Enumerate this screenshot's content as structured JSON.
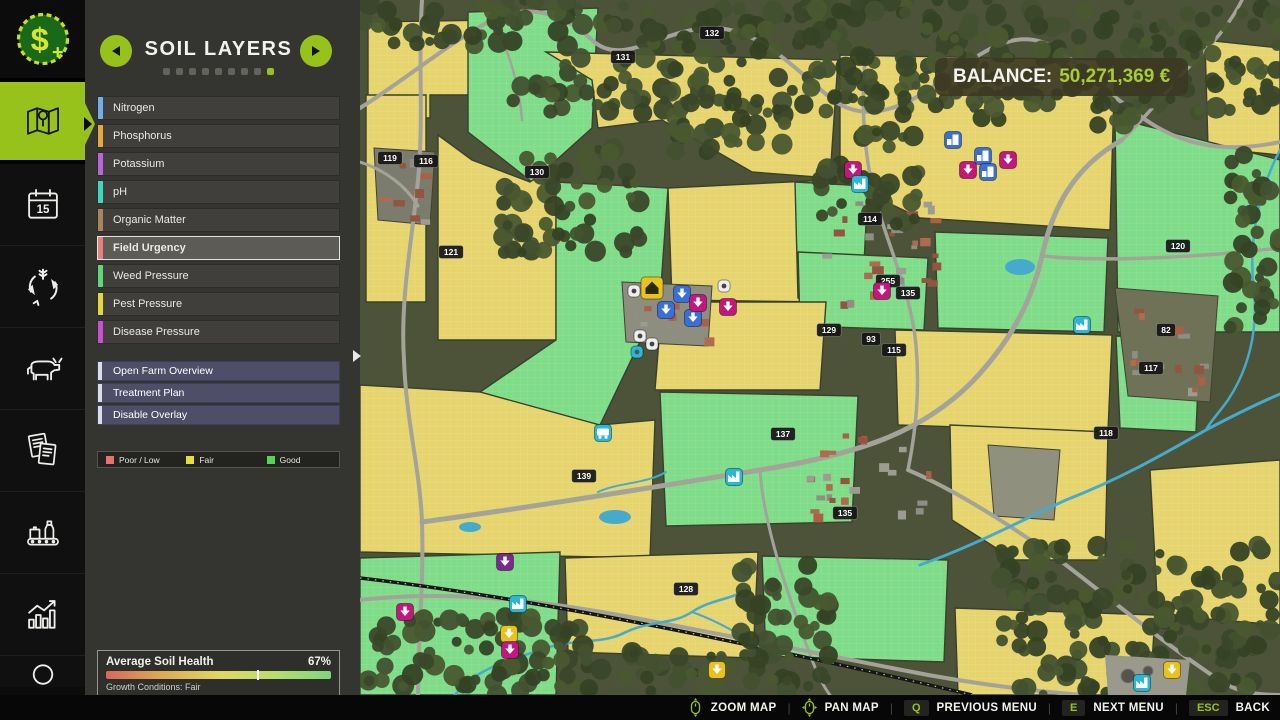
{
  "sidebar": {
    "items": [
      {
        "name": "finances",
        "icon": "money-icon"
      },
      {
        "name": "map",
        "icon": "map-icon",
        "active": true
      },
      {
        "name": "calendar",
        "icon": "calendar-icon",
        "day": "15"
      },
      {
        "name": "crop-rotation",
        "icon": "rotation-icon"
      },
      {
        "name": "animals",
        "icon": "cow-icon"
      },
      {
        "name": "contracts",
        "icon": "contracts-icon"
      },
      {
        "name": "production",
        "icon": "production-icon"
      },
      {
        "name": "statistics",
        "icon": "stats-icon"
      },
      {
        "name": "player",
        "icon": "person-icon"
      }
    ]
  },
  "panel": {
    "title": "SOIL LAYERS",
    "dots_total": 9,
    "dots_active_index": 8,
    "layers": [
      {
        "label": "Nitrogen",
        "color": "#6cb2e8",
        "selected": false
      },
      {
        "label": "Phosphorus",
        "color": "#e8a838",
        "selected": false
      },
      {
        "label": "Potassium",
        "color": "#b668d9",
        "selected": false
      },
      {
        "label": "pH",
        "color": "#3ad9c0",
        "selected": false
      },
      {
        "label": "Organic Matter",
        "color": "#a8845a",
        "selected": false
      },
      {
        "label": "Field Urgency",
        "color": "#e88080",
        "selected": true
      },
      {
        "label": "Weed Pressure",
        "color": "#5fd978",
        "selected": false
      },
      {
        "label": "Pest Pressure",
        "color": "#e3d935",
        "selected": false
      },
      {
        "label": "Disease Pressure",
        "color": "#cc4fd0",
        "selected": false
      }
    ],
    "actions": [
      {
        "label": "Open Farm Overview"
      },
      {
        "label": "Treatment Plan"
      },
      {
        "label": "Disable Overlay"
      }
    ],
    "legend": [
      {
        "label": "Poor / Low",
        "color": "#e8736b"
      },
      {
        "label": "Fair",
        "color": "#e8e03a"
      },
      {
        "label": "Good",
        "color": "#55d455"
      }
    ],
    "soil_health": {
      "title": "Average Soil Health",
      "value": "67%",
      "percent": 67,
      "subtitle": "Growth Conditions: Fair"
    }
  },
  "balance": {
    "label": "BALANCE:",
    "value": "50,271,369 €"
  },
  "bottom_bar": {
    "controls": [
      {
        "type": "mouse",
        "icon": "mouse-zoom-icon",
        "label": "ZOOM MAP"
      },
      {
        "type": "mouse",
        "icon": "mouse-pan-icon",
        "label": "PAN MAP"
      },
      {
        "type": "key",
        "key": "Q",
        "label": "PREVIOUS MENU"
      },
      {
        "type": "key",
        "key": "E",
        "label": "NEXT MENU"
      },
      {
        "type": "key",
        "key": "ESC",
        "label": "BACK"
      }
    ],
    "accent": "#97c21c"
  },
  "map": {
    "colors": {
      "base": "#4c5339",
      "fair": "#e6d46f",
      "fair_grid": "#f0e48e",
      "good": "#7fdc89",
      "good_grid": "#a8ecb0",
      "field_stroke": "#39402b",
      "road": "#a3a39a",
      "river": "#46aacd",
      "rail": "#161616",
      "badge_bg": "#161616",
      "badge_text": "#ffffff",
      "marker_blue": "#3a6fd8",
      "marker_magenta": "#c2187e",
      "marker_cyan": "#2ab8d8",
      "marker_yellow": "#e8c31d",
      "marker_purple": "#7a2a8a",
      "marker_white": "#eeeeee",
      "tree": [
        "#3a4729",
        "#425130",
        "#354224",
        "#49582f"
      ],
      "house": [
        "#a96046",
        "#925540",
        "#8e8e84",
        "#9c9c90",
        "#b06a4e"
      ]
    },
    "fields": [
      {
        "type": "fair",
        "points": "8,22 132,20 132,95 70,95 70,118 8,118"
      },
      {
        "type": "good",
        "points": "108,12 238,8 232,128 172,182 108,132"
      },
      {
        "type": "fair",
        "points": "6,95 66,95 66,302 6,302"
      },
      {
        "type": "fair",
        "points": "78,135 112,160 170,182 196,165 196,340 78,340"
      },
      {
        "type": "fair",
        "points": "186,52 478,60 470,178 392,172 302,120 238,128 232,80"
      },
      {
        "type": "good",
        "points": "196,182 308,188 300,300 240,425 120,432 120,392 196,340"
      },
      {
        "type": "fair",
        "points": "308,188 470,180 466,302 312,300"
      },
      {
        "type": "fair",
        "points": "480,55 755,60 750,230 560,218 480,180"
      },
      {
        "type": "fair",
        "points": "845,40 920,48 920,155 848,148"
      },
      {
        "type": "good",
        "points": "435,182 508,186 502,302 438,298"
      },
      {
        "type": "good",
        "points": "438,252 568,258 564,330 440,326"
      },
      {
        "type": "good",
        "points": "575,232 748,238 744,332 578,328"
      },
      {
        "type": "good",
        "points": "755,118 920,160 920,332 758,332"
      },
      {
        "type": "fair",
        "points": "302,302 466,302 460,390 295,390"
      },
      {
        "type": "fair",
        "points": "535,330 752,335 748,432 538,425"
      },
      {
        "type": "good",
        "points": "756,336 840,338 836,432 760,428"
      },
      {
        "type": "fair",
        "points": "0,385 120,392 240,425 295,420 290,558 0,552"
      },
      {
        "type": "good",
        "points": "0,558 200,552 196,695 0,695"
      },
      {
        "type": "fair",
        "points": "205,558 398,552 393,658 208,652"
      },
      {
        "type": "good",
        "points": "300,392 498,396 492,522 306,526"
      },
      {
        "type": "good",
        "points": "402,556 588,560 584,662 406,656"
      },
      {
        "type": "fair",
        "points": "590,425 748,432 745,560 655,560 592,520"
      },
      {
        "type": "fair",
        "points": "790,470 920,460 920,625 798,615"
      },
      {
        "type": "fair",
        "points": "595,608 795,615 790,695 598,695"
      }
    ],
    "gray_areas": [
      {
        "points": "755,288 858,296 850,402 768,396",
        "fill": "#6f7257"
      },
      {
        "points": "628,445 700,450 694,520 634,516",
        "fill": "#90907e"
      },
      {
        "points": "262,282 352,286 348,346 266,342",
        "fill": "#8d8d80"
      },
      {
        "points": "14,148 75,152 70,225 18,220",
        "fill": "#7c7c6e"
      }
    ],
    "roads": [
      {
        "d": "M0,108 C45,80 90,42 132,20 C165,4 200,10 232,40 C262,68 300,30 348,28 C392,26 424,58 468,96 C498,122 532,112 562,94 C602,70 640,28 682,42 C712,52 736,88 792,124 C836,152 882,150 920,142",
        "w": 4
      },
      {
        "d": "M62,0 C58,60 64,120 58,180 C52,240 40,300 44,360 C46,420 60,470 62,522 C64,580 58,640 58,695",
        "w": 4
      },
      {
        "d": "M62,522 C180,506 300,486 400,470 C500,454 562,432 612,382 C652,340 672,300 682,256 C692,210 712,168 762,140",
        "w": 5
      },
      {
        "d": "M682,256 C740,262 832,258 920,248",
        "w": 3.5
      },
      {
        "d": "M505,60 C500,120 506,170 520,215 C534,260 552,300 556,345 C560,390 556,430 548,470",
        "w": 3.5
      },
      {
        "d": "M0,600 C90,590 180,600 270,617 C360,634 452,652 542,670 C602,682 662,690 722,695",
        "w": 4
      },
      {
        "d": "M548,470 C600,492 660,532 702,562 C752,600 802,642 862,682 C882,694 902,695 920,695",
        "w": 4
      },
      {
        "d": "M762,140 C788,116 818,76 840,56 C856,40 872,20 882,0",
        "w": 3.5
      },
      {
        "d": "M0,162 C25,170 46,186 58,206",
        "w": 3
      },
      {
        "d": "M132,20 C150,50 160,90 162,120",
        "w": 2.5
      },
      {
        "d": "M400,470 C404,530 430,600 452,660 C460,680 466,690 470,695",
        "w": 3
      }
    ],
    "railroads": [
      {
        "d": "M0,578 C120,592 262,618 402,648 C472,663 542,678 612,695"
      }
    ],
    "rivers": [
      {
        "d": "M95,695 C115,668 152,660 186,648 C216,638 242,645 266,632 C292,620 312,625 332,612 C350,600 368,600 382,592",
        "w": 2.5
      },
      {
        "d": "M560,565 C616,545 662,520 706,500 C762,478 802,455 846,430 C880,412 906,400 920,394",
        "w": 3
      },
      {
        "d": "M920,150 C898,192 888,242 894,292 C898,332 888,370 868,400 C858,414 850,422 846,430",
        "w": 2.5
      },
      {
        "d": "M238,492 C260,482 286,484 306,472",
        "w": 2
      },
      {
        "d": "M332,612 C360,622 390,640 412,655",
        "w": 2
      }
    ],
    "ponds": [
      [
        255,
        517,
        16,
        7
      ],
      [
        110,
        527,
        11,
        5
      ],
      [
        660,
        267,
        15,
        8
      ]
    ],
    "treatment": {
      "points": "745,655 830,660 826,695 748,695",
      "fill": "#9a9a8c",
      "tanks": [
        [
          768,
          676,
          7
        ],
        [
          788,
          671,
          5
        ]
      ]
    },
    "forest_zones": [
      [
        150,
        0,
        400,
        115,
        11
      ],
      [
        555,
        0,
        365,
        125,
        22
      ],
      [
        870,
        150,
        50,
        185,
        33
      ],
      [
        140,
        148,
        140,
        105,
        44
      ],
      [
        640,
        545,
        280,
        150,
        55
      ],
      [
        0,
        615,
        235,
        80,
        66
      ],
      [
        225,
        650,
        245,
        45,
        77
      ],
      [
        0,
        0,
        155,
        45,
        88
      ],
      [
        300,
        98,
        130,
        55,
        99
      ],
      [
        460,
        128,
        100,
        100,
        111
      ],
      [
        380,
        565,
        90,
        95,
        122
      ]
    ],
    "village_zones": [
      [
        462,
        196,
        118,
        108,
        7
      ],
      [
        442,
        432,
        125,
        85,
        17
      ],
      [
        265,
        285,
        80,
        58,
        27
      ],
      [
        18,
        152,
        52,
        68,
        37
      ],
      [
        770,
        300,
        70,
        90,
        47
      ]
    ],
    "badges": [
      {
        "n": "119",
        "x": 30,
        "y": 158
      },
      {
        "n": "116",
        "x": 66,
        "y": 161
      },
      {
        "n": "132",
        "x": 352,
        "y": 33
      },
      {
        "n": "131",
        "x": 263,
        "y": 57
      },
      {
        "n": "130",
        "x": 177,
        "y": 172
      },
      {
        "n": "121",
        "x": 91,
        "y": 252
      },
      {
        "n": "114",
        "x": 510,
        "y": 219
      },
      {
        "n": "255",
        "x": 528,
        "y": 281
      },
      {
        "n": "135",
        "x": 548,
        "y": 293
      },
      {
        "n": "129",
        "x": 469,
        "y": 330
      },
      {
        "n": "93",
        "x": 511,
        "y": 339
      },
      {
        "n": "115",
        "x": 534,
        "y": 350
      },
      {
        "n": "120",
        "x": 818,
        "y": 246
      },
      {
        "n": "82",
        "x": 806,
        "y": 330
      },
      {
        "n": "117",
        "x": 791,
        "y": 368
      },
      {
        "n": "137",
        "x": 423,
        "y": 434
      },
      {
        "n": "139",
        "x": 224,
        "y": 476
      },
      {
        "n": "128",
        "x": 326,
        "y": 589
      },
      {
        "n": "118",
        "x": 746,
        "y": 433
      },
      {
        "n": "135",
        "x": 485,
        "y": 513
      }
    ],
    "markers": [
      {
        "x": 593,
        "y": 140,
        "c": "blue",
        "g": "building"
      },
      {
        "x": 623,
        "y": 156,
        "c": "blue",
        "g": "building"
      },
      {
        "x": 628,
        "y": 172,
        "c": "blue",
        "g": "building"
      },
      {
        "x": 608,
        "y": 170,
        "c": "magenta",
        "g": "arrow"
      },
      {
        "x": 648,
        "y": 160,
        "c": "magenta",
        "g": "arrow"
      },
      {
        "x": 493,
        "y": 170,
        "c": "magenta",
        "g": "arrow"
      },
      {
        "x": 500,
        "y": 184,
        "c": "cyan",
        "g": "factory"
      },
      {
        "x": 522,
        "y": 291,
        "c": "magenta",
        "g": "arrow"
      },
      {
        "x": 292,
        "y": 288,
        "c": "yellow",
        "g": "house",
        "s": 22
      },
      {
        "x": 274,
        "y": 291,
        "c": "white",
        "g": "dot",
        "s": 12
      },
      {
        "x": 322,
        "y": 294,
        "c": "blue",
        "g": "arrow"
      },
      {
        "x": 306,
        "y": 310,
        "c": "blue",
        "g": "arrow"
      },
      {
        "x": 333,
        "y": 318,
        "c": "blue",
        "g": "arrow"
      },
      {
        "x": 338,
        "y": 303,
        "c": "magenta",
        "g": "arrow"
      },
      {
        "x": 368,
        "y": 307,
        "c": "magenta",
        "g": "arrow"
      },
      {
        "x": 364,
        "y": 286,
        "c": "white",
        "g": "dot",
        "s": 12
      },
      {
        "x": 280,
        "y": 336,
        "c": "white",
        "g": "dot",
        "s": 12
      },
      {
        "x": 292,
        "y": 344,
        "c": "white",
        "g": "dot",
        "s": 12
      },
      {
        "x": 277,
        "y": 352,
        "c": "cyan",
        "g": "dot",
        "s": 12
      },
      {
        "x": 243,
        "y": 433,
        "c": "cyan",
        "g": "train"
      },
      {
        "x": 374,
        "y": 477,
        "c": "cyan",
        "g": "factory"
      },
      {
        "x": 722,
        "y": 325,
        "c": "cyan",
        "g": "factory"
      },
      {
        "x": 145,
        "y": 562,
        "c": "purple",
        "g": "arrow"
      },
      {
        "x": 158,
        "y": 604,
        "c": "cyan",
        "g": "factory"
      },
      {
        "x": 45,
        "y": 612,
        "c": "magenta",
        "g": "arrow"
      },
      {
        "x": 149,
        "y": 634,
        "c": "yellow",
        "g": "arrow"
      },
      {
        "x": 150,
        "y": 650,
        "c": "magenta",
        "g": "arrow"
      },
      {
        "x": 357,
        "y": 670,
        "c": "yellow",
        "g": "arrow"
      },
      {
        "x": 812,
        "y": 670,
        "c": "yellow",
        "g": "arrow"
      },
      {
        "x": 782,
        "y": 683,
        "c": "cyan",
        "g": "factory"
      }
    ]
  }
}
